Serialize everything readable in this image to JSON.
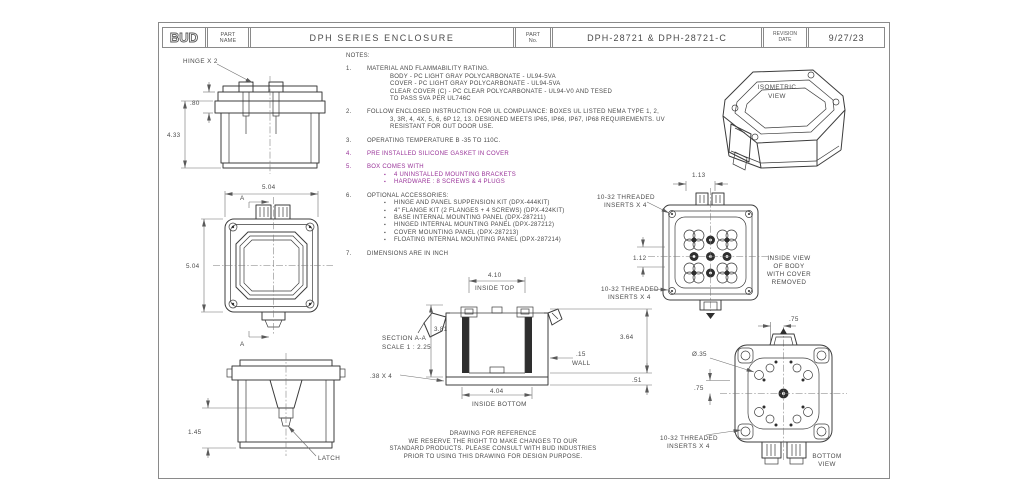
{
  "title_block": {
    "logo": "BUD",
    "part_name_label": [
      "PART",
      "NAME"
    ],
    "part_name": "DPH SERIES ENCLOSURE",
    "part_no_label": [
      "PART",
      "No."
    ],
    "part_no": "DPH-28721 & DPH-28721-C",
    "revision_label": [
      "REVISION",
      "DATE"
    ],
    "revision_date": "9/27/23"
  },
  "colors": {
    "line": "#3c3c3c",
    "note_accent": "#993399"
  },
  "notes": {
    "heading": "NOTES:",
    "items": [
      {
        "num": "1.",
        "text": "MATERIAL AND FLAMMABILITY RATING.",
        "lines": [
          "BODY - PC LIGHT GRAY POLYCARBONATE - UL94-5VA",
          "COVER - PC LIGHT GRAY POLYCARBONATE - UL94-5VA",
          "CLEAR COVER (C) - PC CLEAR POLYCARBONATE - UL94-V0 AND TESED",
          "TO PASS 5VA PER UL746C"
        ]
      },
      {
        "num": "2.",
        "text": "FOLLOW ENCLOSED INSTRUCTION FOR UL COMPLIANCE: BOXES UL LISTED NEMA TYPE 1, 2,",
        "lines": [
          "3, 3R, 4, 4X, 5, 6, 6P 12, 13. DESIGNED MEETS IP65, IP66, IP67, IP68 REQUIREMENTS. UV",
          "RESISTANT FOR OUT DOOR USE."
        ]
      },
      {
        "num": "3.",
        "text": "OPERATING TEMPERATURE B -35 TO 110C."
      },
      {
        "num": "4.",
        "text": "PRE INSTALLED SILICONE GASKET IN COVER"
      },
      {
        "num": "5.",
        "text": "BOX COMES WITH",
        "bullets": [
          "4 UNINSTALLED MOUNTING BRACKETS",
          "HARDWARE : 8 SCREWS & 4 PLUGS"
        ]
      },
      {
        "num": "6.",
        "text": "OPTIONAL ACCESSORIES:",
        "bullets": [
          "HINGE AND PANEL SUPPENSION KIT  (DPX-444KIT)",
          "4\" FLANGE KIT (2 FLANGES + 4 SCREWS)  (DPX-424KIT)",
          "BASE INTERNAL MOUNTING PANEL  (DPX-287211)",
          "HINGED INTERNAL MOUNTING PANEL  (DPX-287212)",
          "COVER MOUNTING PANEL  (DPX-287213)",
          "FLOATING INTERNAL MOUNTING PANEL  (DPX-287214)"
        ]
      },
      {
        "num": "7.",
        "text": "DIMENSIONS ARE IN INCH"
      }
    ]
  },
  "views": {
    "side_top": {
      "callout_hinge": "HINGE X 2",
      "dim_lid": ".80",
      "dim_height": "4.33"
    },
    "front": {
      "dim_width": "5.04",
      "dim_height": "5.04",
      "section_letter_top": "A",
      "section_letter_bottom": "A"
    },
    "side_bottom": {
      "dim_latch": "1.45",
      "callout_latch": "LATCH"
    },
    "section": {
      "label_1": "SECTION A-A",
      "label_2": "SCALE 1 : 2.25",
      "dim_inside_top": "4.10",
      "inside_top_label": "INSIDE TOP",
      "dim_depth": "3.81",
      "dim_wall": ".15",
      "wall_label": "WALL",
      "dim_rib": ".38 X 4",
      "dim_inside_bottom": "4.04",
      "inside_bottom_label": "INSIDE BOTTOM",
      "dim_height": "3.64",
      "dim_base": ".51"
    },
    "isometric": {
      "label_lines": [
        "ISOMETRIC",
        "VIEW"
      ]
    },
    "inside": {
      "dim_top": "1.13",
      "dim_left": "1.12",
      "callout_inserts_top": [
        "10-32 THREADED",
        "INSERTS X 4"
      ],
      "callout_inserts_bottom": [
        "10-32 THREADED",
        "INSERTS X 4"
      ],
      "label_lines": [
        "INSIDE VIEW",
        "OF BODY",
        "WITH COVER",
        "REMOVED"
      ]
    },
    "bottom": {
      "dim_top": ".75",
      "dim_left": ".75",
      "callout_dia": "Ø.35",
      "callout_inserts": [
        "10-32 THREADED",
        "INSERTS X 4"
      ],
      "label_lines": [
        "BOTTOM",
        "VIEW"
      ]
    }
  },
  "disclaimer": {
    "line1": "DRAWING FOR REFERENCE",
    "line2": "WE RESERVE THE RIGHT TO MAKE CHANGES TO OUR",
    "line3": "STANDARD PRODUCTS. PLEASE CONSULT WITH BUD INDUSTRIES",
    "line4": "PRIOR TO USING THIS DRAWING FOR DESIGN PURPOSE."
  }
}
